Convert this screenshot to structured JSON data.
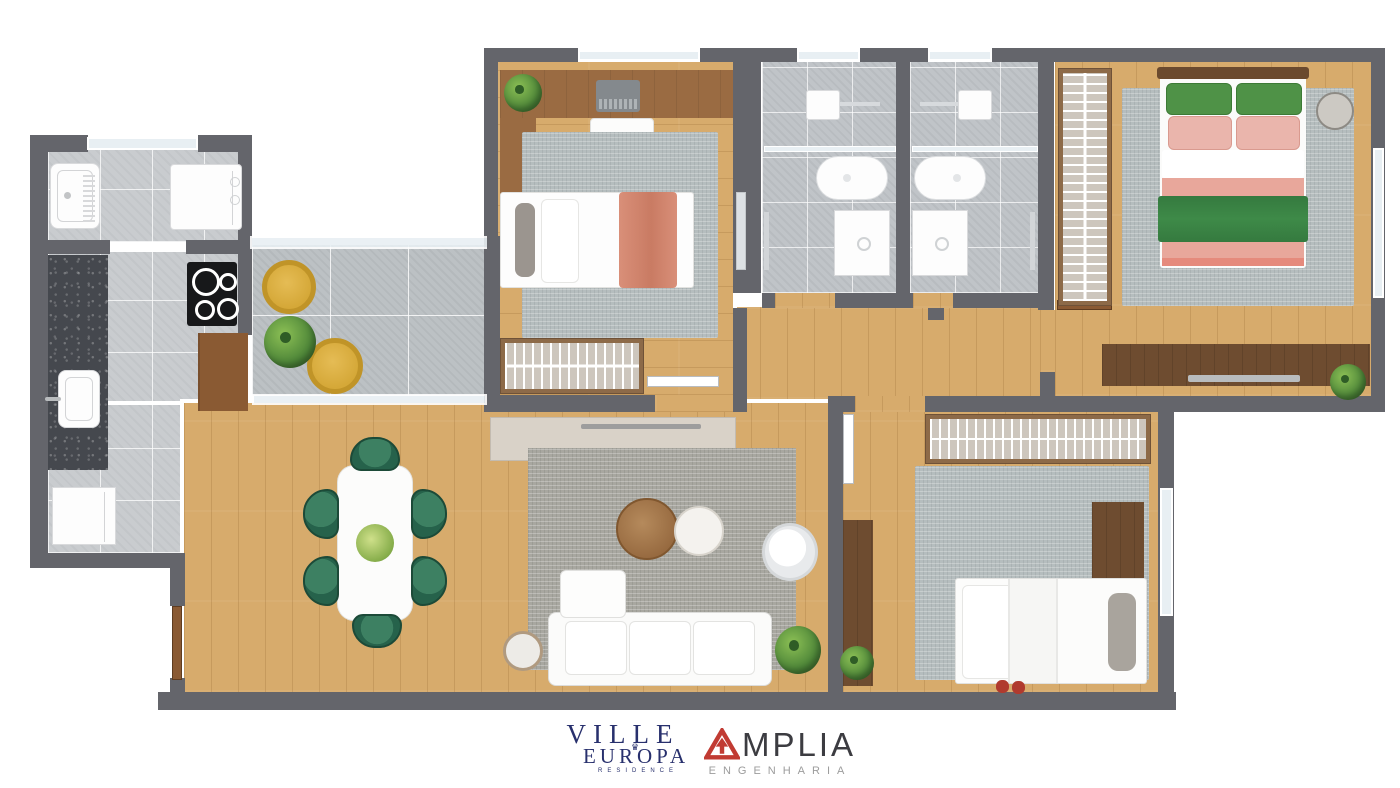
{
  "page": {
    "background": "#ffffff",
    "type": "apartment floor plan rendering"
  },
  "branding": {
    "ville": {
      "line1": "VILLE",
      "line2": "EUROPA",
      "crown": "♛",
      "tagline": "RESIDENCE"
    },
    "amplia": {
      "name_rest": "MPLIA",
      "subtitle": "ENGENHARIA"
    }
  },
  "palette": {
    "wall": "#64656b",
    "glass": "#e8eff3",
    "tile": "#c9cccf",
    "tileBath": "#c0c4c8",
    "tileBalcony": "#bcc1c4",
    "wood": "#d7ab6c",
    "granite": "#45484e",
    "rug": "#b5bdbe",
    "rugLiving": "#a8a7a0",
    "chairGreen": "#26624b",
    "chairYellow": "#d5a838",
    "wardrobeWood": "#8d6a48",
    "wardrobeFill": "#cdc6bd",
    "darkWood": "#6e4c30",
    "doorWood": "#8a5a33",
    "salmon": "#d98f79",
    "pinkBed": "#e8a79b",
    "pinkPillow": "#eab5ac",
    "greenBed": "#3e8a48",
    "greenPillow": "#4f9247",
    "sideboard": "#d9d2c8",
    "villeNavy": "#28306d",
    "ampliaRed": "#c13b33",
    "ampliaText": "#3c3c41",
    "ampliaGray": "#9c9c9c"
  },
  "inventory": {
    "service_area": [
      "laundry-tub",
      "washing-machine"
    ],
    "kitchen": [
      "granite-counter",
      "kitchen-sink",
      "cooktop",
      "wood-cabinet",
      "fridge"
    ],
    "balcony": [
      "yellow-armchair",
      "yellow-armchair",
      "potted-plant"
    ],
    "dining": [
      "dining-table",
      "green-chair x6",
      "table-plant"
    ],
    "living": [
      "tv-sideboard",
      "area-rug",
      "coffee-table-wood",
      "coffee-table-white",
      "sofa",
      "round-armchair",
      "side-table",
      "potted-plant"
    ],
    "bedroom_1": [
      "desk",
      "laptop",
      "desk-plant",
      "desk-chair",
      "rug",
      "single-bed",
      "open-wardrobe",
      "mirror"
    ],
    "bathroom_1": [
      "shower",
      "toilet",
      "vanity-sink",
      "towel-bar"
    ],
    "bathroom_2": [
      "shower",
      "toilet",
      "vanity-sink",
      "towel-bar"
    ],
    "master_bedroom": [
      "open-wardrobe",
      "rug",
      "double-bed",
      "round-side-table",
      "tv-sideboard",
      "potted-plant"
    ],
    "bedroom_2": [
      "open-wardrobe",
      "rug",
      "desk",
      "single-bed",
      "slippers",
      "console",
      "potted-plant"
    ]
  }
}
